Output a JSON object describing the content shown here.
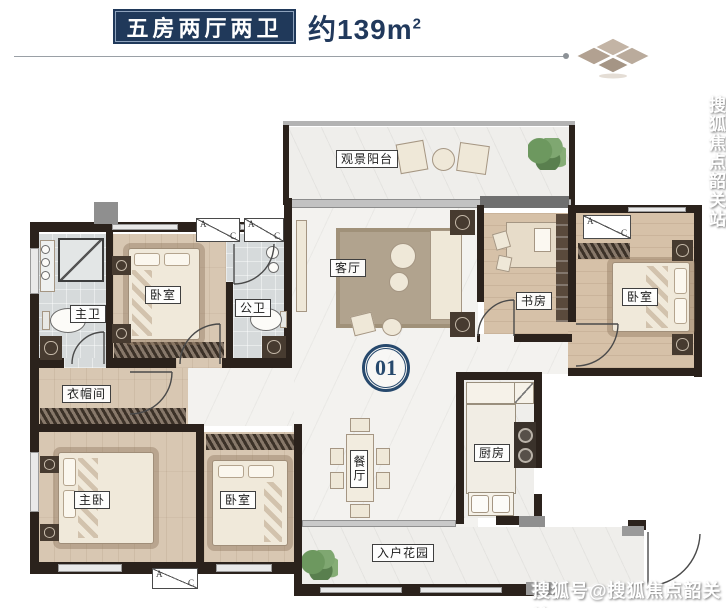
{
  "header": {
    "banner_label": "五房两厅两卫",
    "area_text": "约139m",
    "area_exponent": "2"
  },
  "plan": {
    "unit_number": "01",
    "rooms": {
      "balcony": "观景阳台",
      "living_room": "客厅",
      "study": "书房",
      "bedroom_right": "卧室",
      "master_bathroom": "主卫",
      "bedroom_top": "卧室",
      "public_bathroom": "公卫",
      "cloakroom": "衣帽间",
      "master_bedroom": "主卧",
      "bedroom_bottom": "卧室",
      "dining_room": "餐厅",
      "kitchen": "厨房",
      "entry_garden": "入户花园"
    },
    "ac_unit": {
      "left_letter": "A",
      "right_letter": "C"
    }
  },
  "watermarks": {
    "side_vertical": "搜狐焦点韶关站",
    "bottom_right": "搜狐号@搜狐焦点韶关站"
  },
  "colors": {
    "navy": "#20395a",
    "wall_dark": "#2b221c",
    "wood_floor": "#d8c7b2",
    "marble_floor": "#f3f2ef",
    "tile_floor": "#d6dadb",
    "diamond_tan": "#b7a797",
    "plant_green": "#679160"
  }
}
